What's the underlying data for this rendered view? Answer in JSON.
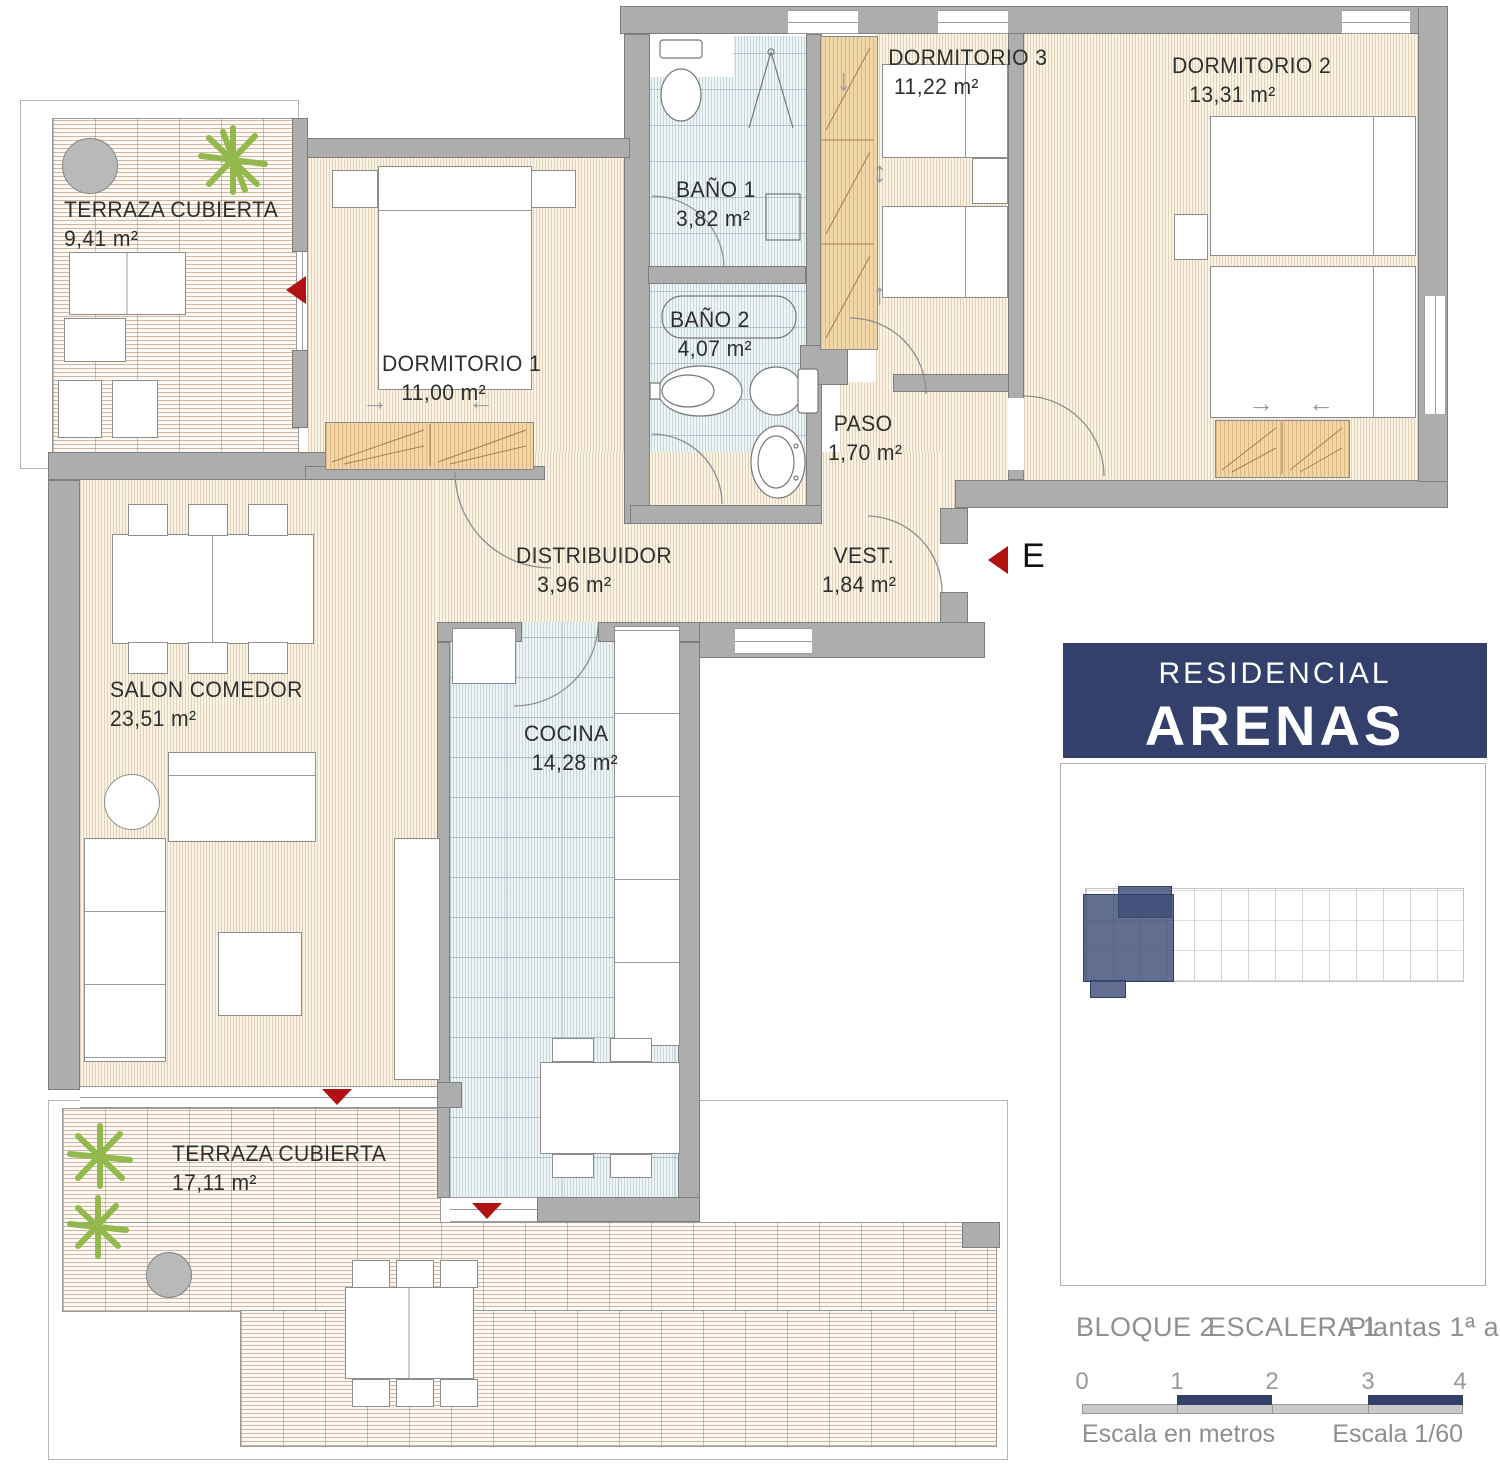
{
  "plan": {
    "rooms": {
      "terraza_superior": {
        "name": "TERRAZA CUBIERTA",
        "area": "9,41 m²"
      },
      "dormitorio_1": {
        "name": "DORMITORIO 1",
        "area": "11,00 m²"
      },
      "bano_1": {
        "name": "BAÑO 1",
        "area": "3,82 m²"
      },
      "bano_2": {
        "name": "BAÑO 2",
        "area": "4,07 m²"
      },
      "dormitorio_3": {
        "name": "DORMITORIO 3",
        "area": "11,22 m²"
      },
      "dormitorio_2": {
        "name": "DORMITORIO 2",
        "area": "13,31 m²"
      },
      "paso": {
        "name": "PASO",
        "area": "1,70 m²"
      },
      "distribuidor": {
        "name": "DISTRIBUIDOR",
        "area": "3,96 m²"
      },
      "vestibulo": {
        "name": "VEST.",
        "area": "1,84 m²"
      },
      "salon_comedor": {
        "name": "SALON COMEDOR",
        "area": "23,51 m²"
      },
      "cocina": {
        "name": "COCINA",
        "area": "14,28 m²"
      },
      "terraza_inferior": {
        "name": "TERRAZA CUBIERTA",
        "area": "17,11 m²"
      }
    },
    "entrance_label": "E",
    "compass_label": "N",
    "glyphs": {
      "arrow_right": "→",
      "arrow_left": "←",
      "arrow_down": "↓",
      "arrow_up_down": "↕",
      "arrow_up": "↑"
    }
  },
  "branding": {
    "line1": "RESIDENCIAL",
    "line2": "ARENAS"
  },
  "caption": {
    "bloque": "BLOQUE 2",
    "escalera": "ESCALERA 1",
    "plantas": "Plantas 1ª a 3ª"
  },
  "scale_bar": {
    "ticks": [
      "0",
      "1",
      "2",
      "3",
      "4"
    ],
    "unit_label": "Escala en metros",
    "ratio_label": "Escala 1/60"
  },
  "colors": {
    "accent_red": "#b01111",
    "brand_navy": "#32406b",
    "wall_gray": "#adadad",
    "deck_line": "#ad7e5c",
    "bath_blue": "#8caabb",
    "wardrobe_tan": "#f1d6a7",
    "site_highlight": "#404e78"
  }
}
